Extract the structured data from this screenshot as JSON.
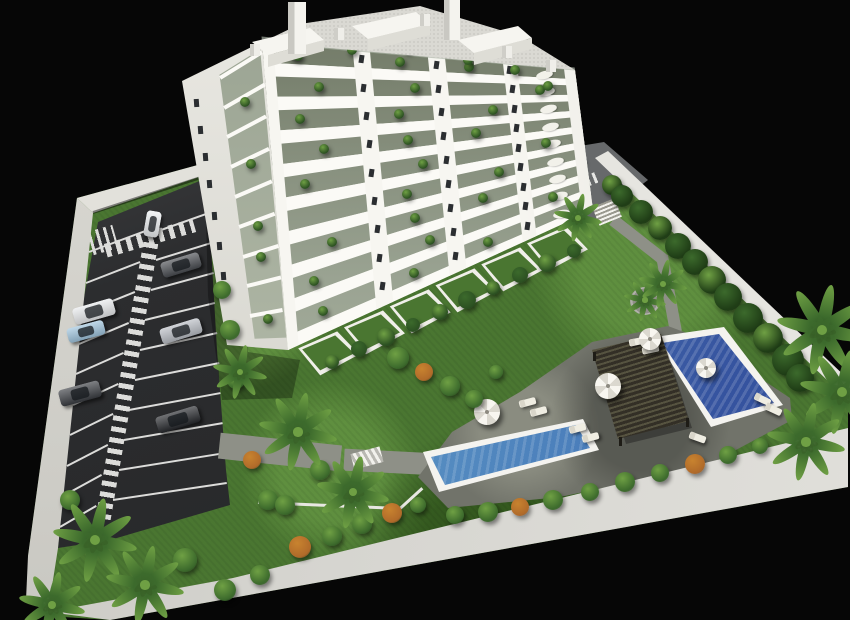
{
  "scene": {
    "description": "Aerial 3D architectural rendering of a white multi-storey apartment building with balconies, landscaped garden, two blue swimming pools, dark pergola lounge deck, sun loungers, parasols, palm trees and a private parking lot with cars, enclosed by white perimeter walls on a black background",
    "style": "3d-render",
    "background": "#060606"
  },
  "palette": {
    "lawn_base": "#4a7631",
    "lawn_light": "#5f8f3f",
    "lawn_dark": "#34591f",
    "asphalt": "#2c2d2f",
    "asphalt_light": "#4a4b4d",
    "stripe": "#dcdcda",
    "path": "#8e9087",
    "driveway": "#67696b",
    "terrace": "#71736a",
    "terrace_light": "#8a8c80",
    "wall_top": "#e2e1db",
    "wall_left": "#dcdbd5",
    "wall_right": "#e6e5e0",
    "wall_bottom": "#d5d4cf",
    "facade": "#f7f6f1",
    "facade_side": "#e9e8e2",
    "slab": "#fbfaf6",
    "glass_top": "#6d7562",
    "glass_mid": "#9aa392",
    "glass_low": "#bcc3b1",
    "window": "#2b2e31",
    "roof": "#dad9d3",
    "penthouse_front": "#deddd6",
    "plant_dark": "#2c5122",
    "plant_mid": "#3c6a2c",
    "plant_light": "#6fa044",
    "bush_orange": "#b06a2a",
    "pool_deep": "#3a63ad",
    "pool_light": "#7cc0d8",
    "coping": "#f4f3ef",
    "pergola": "#332f26",
    "pergola_slat": "#565340",
    "furniture": "#efede2"
  },
  "building": {
    "floors": 9,
    "pier_columns": 5,
    "window_columns": 3,
    "roof_towers": 2,
    "penthouse_boxes": 3,
    "ground_floor_private_gardens": 6
  },
  "parking": {
    "stalls_left": 10,
    "stalls_right": 10,
    "has_center_striped_walkway": true,
    "has_entry_crosswalk": true,
    "cars": [
      {
        "label": "white car driving in lane",
        "color": "#eceff1",
        "x": 152,
        "y": 224,
        "w": 15,
        "h": 26,
        "rot": 10
      },
      {
        "label": "dark grey sedan",
        "color": "#4a4d52",
        "x": 181,
        "y": 265,
        "w": 40,
        "h": 16,
        "rot": -17
      },
      {
        "label": "white suv",
        "color": "#e8eaec",
        "x": 94,
        "y": 311,
        "w": 42,
        "h": 17,
        "rot": -16
      },
      {
        "label": "light blue car",
        "color": "#9fc4dd",
        "x": 86,
        "y": 331,
        "w": 38,
        "h": 15,
        "rot": -15
      },
      {
        "label": "silver sedan",
        "color": "#b9bdc4",
        "x": 181,
        "y": 331,
        "w": 42,
        "h": 16,
        "rot": -17
      },
      {
        "label": "dark suv",
        "color": "#3a3d42",
        "x": 80,
        "y": 393,
        "w": 42,
        "h": 17,
        "rot": -15
      },
      {
        "label": "black sedan",
        "color": "#26282c",
        "x": 178,
        "y": 419,
        "w": 44,
        "h": 17,
        "rot": -17
      },
      {
        "label": "white car at rear driveway",
        "color": "#eceff1",
        "x": 577,
        "y": 166,
        "w": 13,
        "h": 21,
        "rot": 14
      }
    ]
  },
  "pools": [
    {
      "name": "main lap pool",
      "water_from": "#7cc0d8",
      "water_to": "#3f6fb4"
    },
    {
      "name": "upper plunge pool",
      "water_from": "#6fa9d0",
      "water_to": "#35539f"
    }
  ],
  "amenities": {
    "pergola": 1,
    "parasols": 4,
    "sun_loungers": 9,
    "deck_chairs": 4
  },
  "vegetation": {
    "palm_trees": 12,
    "wall_hedge_trees": 12,
    "shrubs": 40,
    "balcony_plants": true
  }
}
